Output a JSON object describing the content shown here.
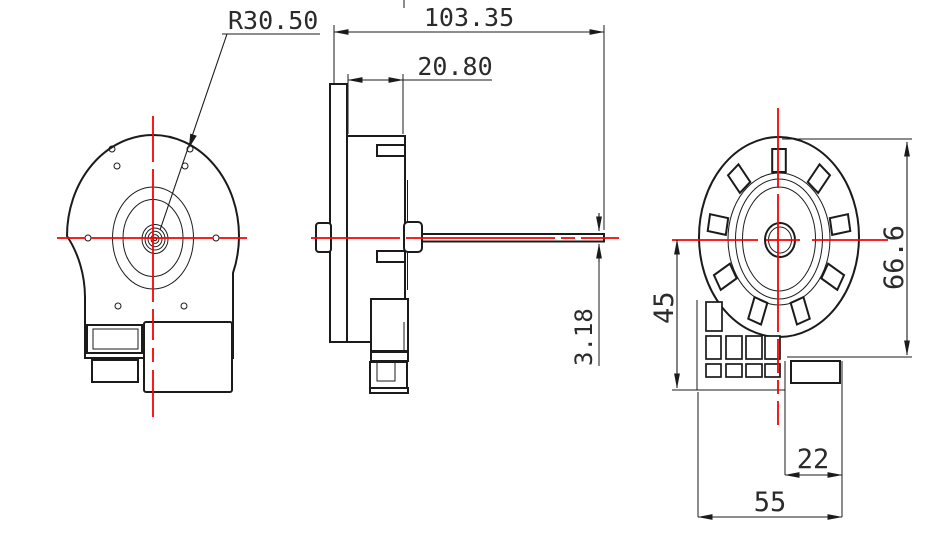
{
  "drawing": {
    "dimensions": {
      "radius": "R30.50",
      "overall_length": "103.35",
      "body_width": "20.80",
      "shaft_diameter": "3.18",
      "center_to_base": "45",
      "body_height": "66.6",
      "terminal_offset": "22",
      "base_width": "55"
    },
    "colors": {
      "line": "#1b1b1b",
      "centerline": "#fb0202",
      "background": "#ffffff"
    }
  }
}
